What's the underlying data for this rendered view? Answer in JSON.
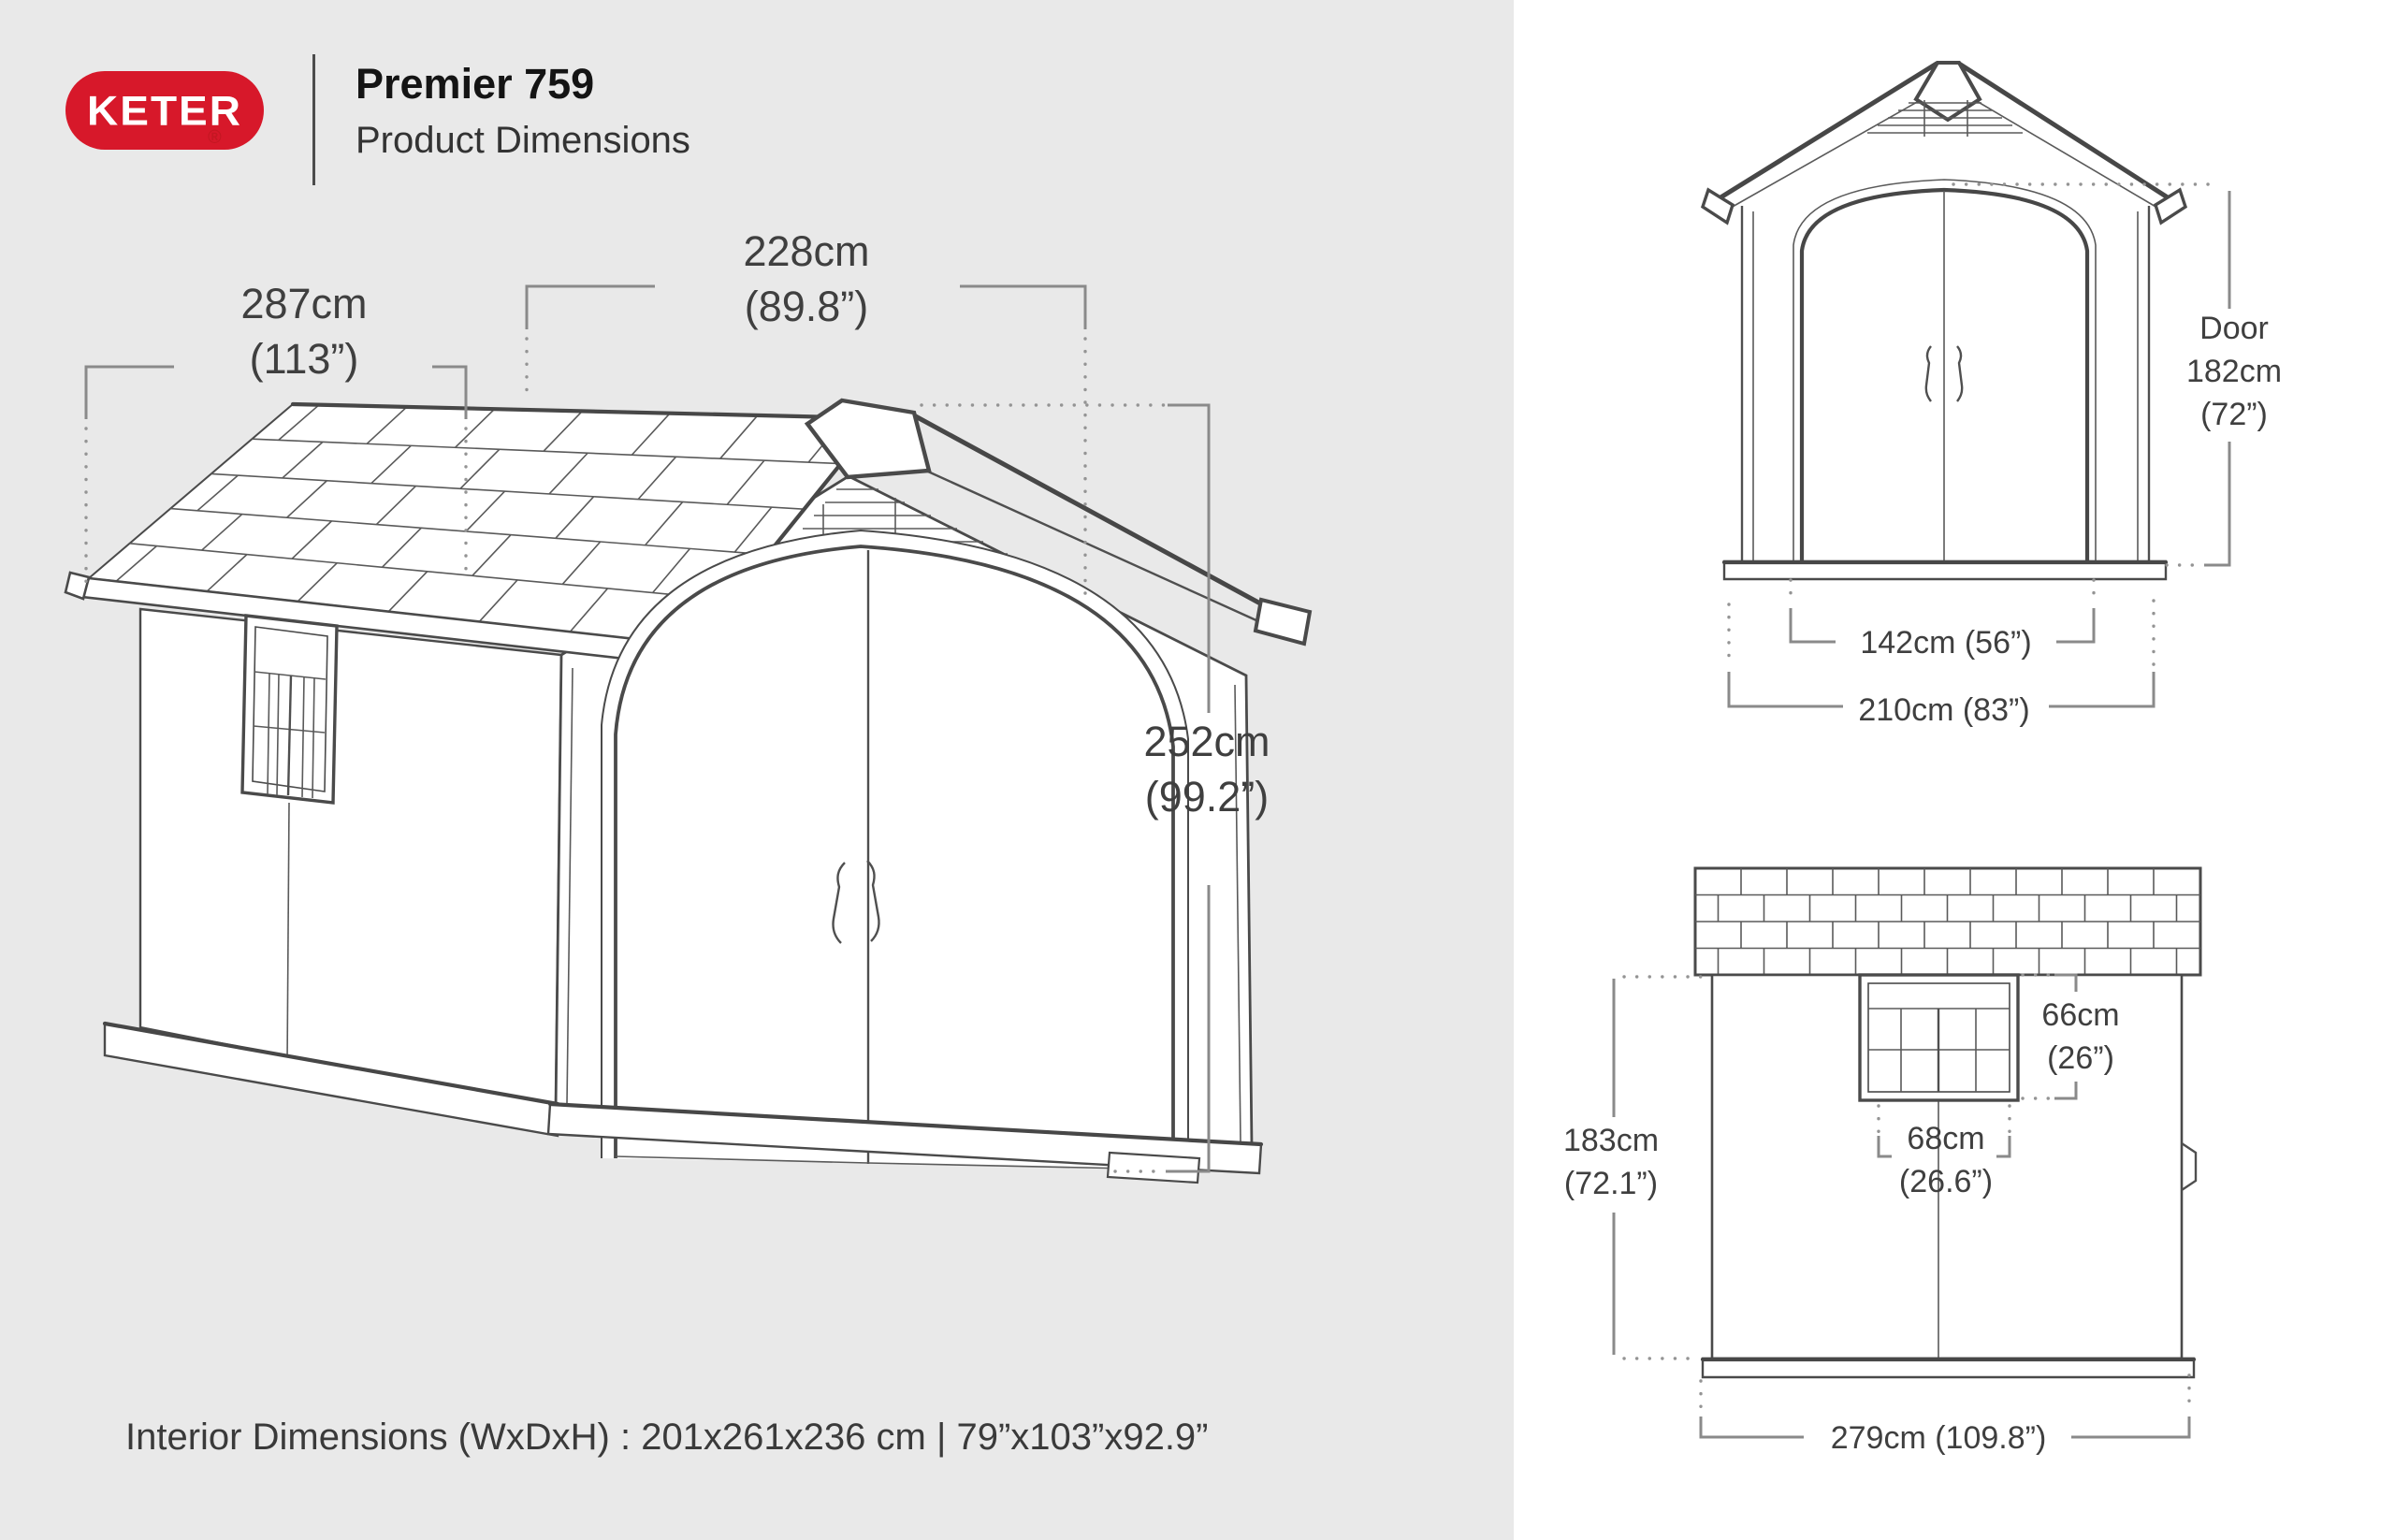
{
  "header": {
    "brand": "KETER",
    "registered_mark": "®",
    "title": "Premier 759",
    "subtitle": "Product Dimensions",
    "brand_color": "#d7182a"
  },
  "main_view": {
    "depth": {
      "line1": "287cm",
      "line2": "(113”)"
    },
    "width": {
      "line1": "228cm",
      "line2": "(89.8”)"
    },
    "height": {
      "line1": "252cm",
      "line2": "(99.2”)"
    }
  },
  "front_view": {
    "door": {
      "line1": "Door",
      "line2": "182cm",
      "line3": "(72”)"
    },
    "inner_width": "142cm (56”)",
    "outer_width": "210cm (83”)"
  },
  "side_view": {
    "window_height": {
      "line1": "66cm",
      "line2": "(26”)"
    },
    "window_width": {
      "line1": "68cm",
      "line2": "(26.6”)"
    },
    "wall_height": {
      "line1": "183cm",
      "line2": "(72.1”)"
    },
    "total_width": "279cm (109.8”)"
  },
  "footer": {
    "interior_dimensions": "Interior Dimensions (WxDxH) : 201x261x236 cm | 79”x103”x92.9”"
  },
  "colors": {
    "background_left": "#e9e9e9",
    "background_right": "#ffffff",
    "line_dark": "#4a4a4a",
    "dimension_gray": "#8a8a8a",
    "text": "#3f3f3f",
    "keter_red": "#d7182a"
  }
}
